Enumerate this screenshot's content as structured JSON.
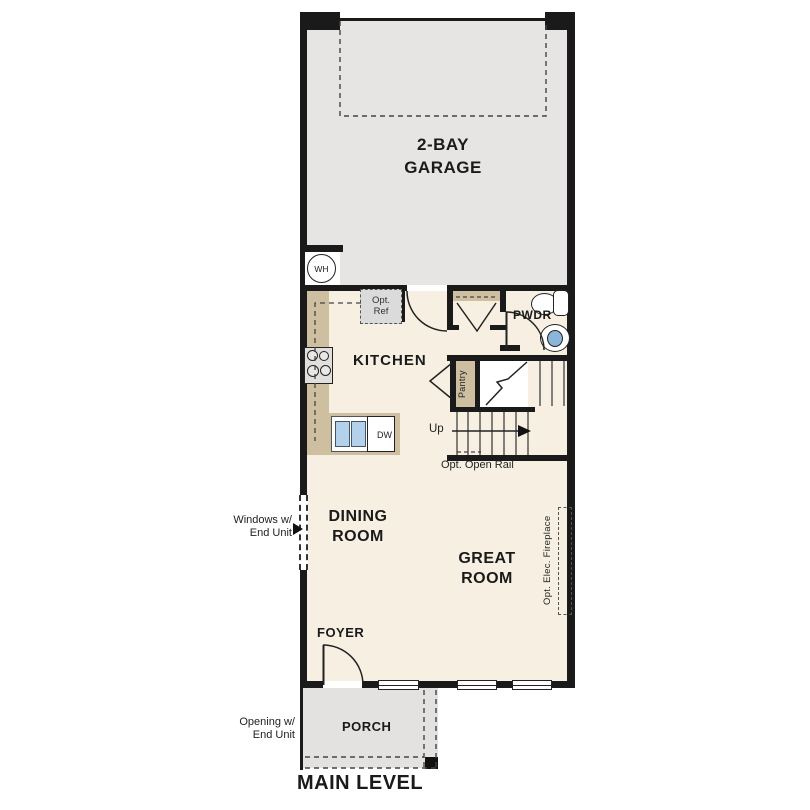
{
  "title": "MAIN LEVEL",
  "rooms": {
    "garage": {
      "line1": "2-BAY",
      "line2": "GARAGE"
    },
    "kitchen": "KITCHEN",
    "powder": "PWDR",
    "pantry": "Pantry",
    "dining": {
      "line1": "DINING",
      "line2": "ROOM"
    },
    "great": {
      "line1": "GREAT",
      "line2": "ROOM"
    },
    "foyer": "FOYER",
    "porch": "PORCH"
  },
  "fixtures": {
    "water_heater": "WH",
    "dishwasher": "DW",
    "opt_refrigerator": {
      "line1": "Opt.",
      "line2": "Ref"
    }
  },
  "stairs": {
    "direction": "Up",
    "note": "Opt. Open Rail"
  },
  "annotations": {
    "left_windows": {
      "line1": "Windows w/",
      "line2": "End Unit"
    },
    "porch_opening": {
      "line1": "Opening w/",
      "line2": "End Unit"
    },
    "fireplace": "Opt. Elec. Fireplace"
  },
  "colors": {
    "wall": "#1a1a1a",
    "floor": "#f7f0e2",
    "garage_floor": "#e6e5e3",
    "porch_floor": "#e3e2e0",
    "counter": "#cdbfa0",
    "appliance": "#dddcda",
    "sink_blue": "#b3d1ea",
    "basin_blue": "#8ab6d9"
  }
}
